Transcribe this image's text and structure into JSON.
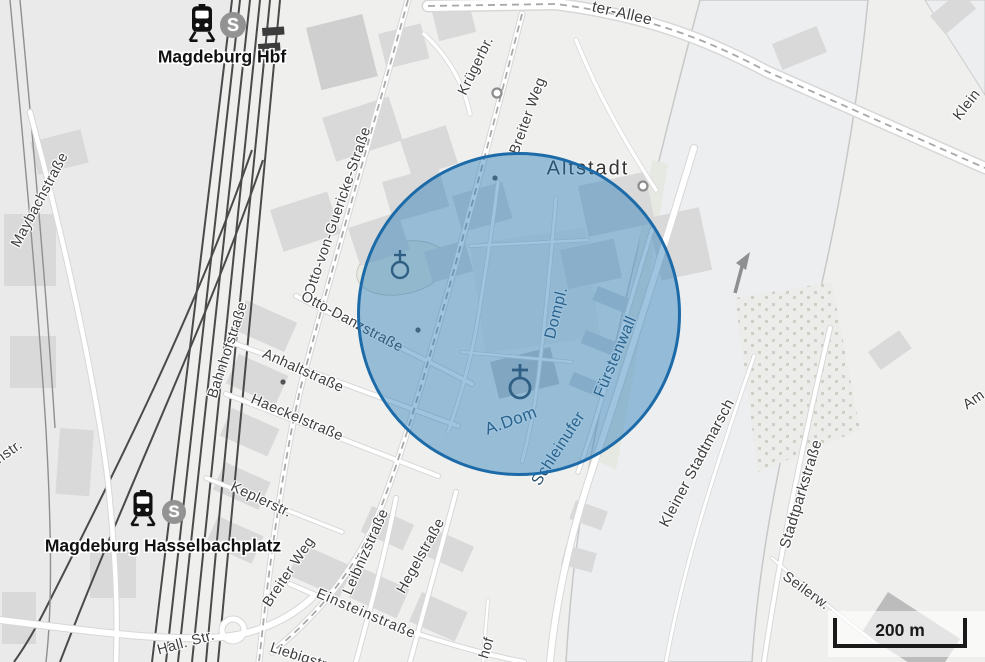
{
  "map": {
    "scale_bar": {
      "label": "200 m"
    },
    "stations": [
      {
        "name": "magdeburg-hbf",
        "label": "Magdeburg Hbf",
        "badge": "S"
      },
      {
        "name": "magdeburg-hasselbachplatz",
        "label": "Magdeburg Hasselbachplatz",
        "badge": "S"
      }
    ],
    "labels": [
      {
        "name": "label-ter-allee",
        "text": "ter-Allee",
        "x": 622,
        "y": 14,
        "rot": 13,
        "size": 15.5,
        "kind": "street"
      },
      {
        "name": "label-kruegerbruecke",
        "text": "Krügerbr.",
        "x": 476,
        "y": 66,
        "rot": -64,
        "kind": "street"
      },
      {
        "name": "label-breiter-weg-north",
        "text": "Breiter Weg",
        "x": 528,
        "y": 116,
        "rot": -70,
        "kind": "street"
      },
      {
        "name": "label-altstadt",
        "text": "Altstadt",
        "x": 588,
        "y": 169,
        "rot": 0,
        "kind": "place"
      },
      {
        "name": "label-klein",
        "text": "Klein",
        "x": 967,
        "y": 105,
        "rot": -52,
        "kind": "street"
      },
      {
        "name": "label-maybachstrasse",
        "text": "Maybachstraße",
        "x": 40,
        "y": 200,
        "rot": -62,
        "kind": "street"
      },
      {
        "name": "label-otto-von-guericke-strasse",
        "text": "Otto-von-Guericke-Straße",
        "x": 338,
        "y": 211,
        "rot": -71,
        "kind": "street"
      },
      {
        "name": "label-bahnhofstrasse",
        "text": "Bahnhofstraße",
        "x": 228,
        "y": 350,
        "rot": -72,
        "kind": "street"
      },
      {
        "name": "label-otto-danzstrasse",
        "text": "Otto-Danzstraße",
        "x": 352,
        "y": 322,
        "rot": 28,
        "kind": "street"
      },
      {
        "name": "label-anhaltstrasse",
        "text": "Anhaltstraße",
        "x": 303,
        "y": 371,
        "rot": 24,
        "kind": "street"
      },
      {
        "name": "label-haeckelstrasse",
        "text": "Haeckelstraße",
        "x": 297,
        "y": 418,
        "rot": 23,
        "kind": "street"
      },
      {
        "name": "label-keplerstrasse",
        "text": "Keplerstr.",
        "x": 261,
        "y": 500,
        "rot": 25,
        "kind": "street"
      },
      {
        "name": "label-dompl",
        "text": "Dompl.",
        "x": 557,
        "y": 313,
        "rot": -76,
        "kind": "inside"
      },
      {
        "name": "label-fuerstenwall",
        "text": "Fürstenwall",
        "x": 616,
        "y": 357,
        "rot": -67,
        "kind": "inside"
      },
      {
        "name": "label-schleinufer",
        "text": "Schleinufer",
        "x": 559,
        "y": 449,
        "rot": -57,
        "kind": "inside"
      },
      {
        "name": "label-a-dom",
        "text": "A.Dom",
        "x": 511,
        "y": 421,
        "rot": -20,
        "size": 17,
        "kind": "inside"
      },
      {
        "name": "label-kleiner-stadtmarsch",
        "text": "Kleiner Stadtmarsch",
        "x": 697,
        "y": 463,
        "rot": -62,
        "size": 15,
        "kind": "street"
      },
      {
        "name": "label-stadtparkstrasse",
        "text": "Stadtparkstraße",
        "x": 801,
        "y": 494,
        "rot": -73,
        "size": 15,
        "kind": "street"
      },
      {
        "name": "label-am",
        "text": "Am",
        "x": 974,
        "y": 400,
        "rot": -35,
        "kind": "street"
      },
      {
        "name": "label-seilerweg",
        "text": "Seilerw.",
        "x": 806,
        "y": 591,
        "rot": 36,
        "kind": "street"
      },
      {
        "name": "label-breiter-weg-south",
        "text": "Breiter Weg",
        "x": 289,
        "y": 572,
        "rot": -56,
        "kind": "street"
      },
      {
        "name": "label-leibnizstrasse",
        "text": "Leibnizstraße",
        "x": 366,
        "y": 552,
        "rot": -66,
        "kind": "street"
      },
      {
        "name": "label-hegelstrasse",
        "text": "Hegelstraße",
        "x": 421,
        "y": 556,
        "rot": -61,
        "kind": "street"
      },
      {
        "name": "label-einsteinstrasse",
        "text": "Einsteinstraße",
        "x": 366,
        "y": 614,
        "rot": 23,
        "spacing": 1,
        "kind": "street"
      },
      {
        "name": "label-hall-str",
        "text": "Hall. Str.",
        "x": 186,
        "y": 643,
        "rot": -15,
        "kind": "street"
      },
      {
        "name": "label-liebigstrasse",
        "text": "Liebigstr.",
        "x": 300,
        "y": 657,
        "rot": 18,
        "kind": "street"
      },
      {
        "name": "label-hof",
        "text": "hof",
        "x": 487,
        "y": 648,
        "rot": -73,
        "kind": "street"
      },
      {
        "name": "label-nstr",
        "text": "nstr.",
        "x": 9,
        "y": 452,
        "rot": -35,
        "kind": "street"
      }
    ],
    "colors": {
      "overlay_fill_rgba": "rgba(42,125,184,0.45)",
      "overlay_stroke": "#1c6ba8",
      "land": "#eff0ee",
      "water": "#eceef0",
      "building": "#d9d9d9",
      "road_fill": "#ffffff",
      "road_casing": "#d7d7d7",
      "railway": "#4a4a4a",
      "street_label": "#3e3e3e",
      "place_label": "#333333",
      "inside_label": "#2d4f68",
      "station_label": "#111111",
      "station_badge": "#929292",
      "halo": "#ffffff"
    }
  }
}
